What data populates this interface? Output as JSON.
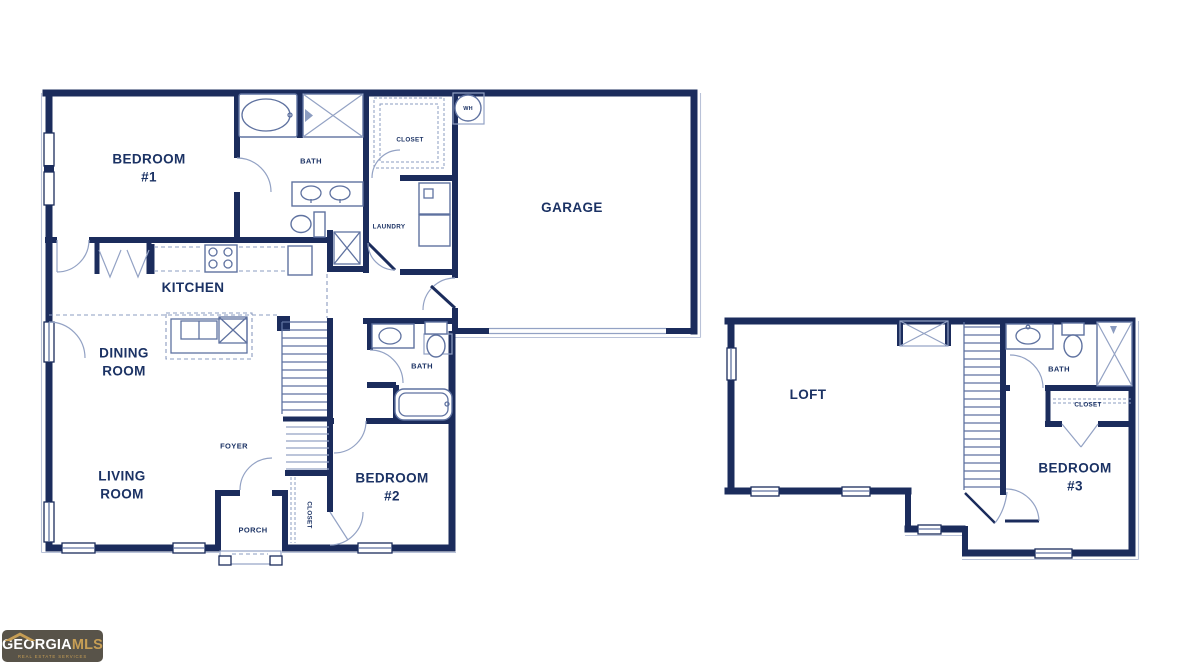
{
  "colors": {
    "wall_navy": "#1b2c5c",
    "fixture_line": "#5f72a0",
    "arc_line": "#93a2c4",
    "label_text": "#1b3264",
    "logo_background": "#585349",
    "logo_gold": "#c79e55",
    "logo_white": "#ffffff"
  },
  "floor1": {
    "labels": {
      "bedroom1": "BEDROOM\n#1",
      "bath1": "BATH",
      "closet1": "CLOSET",
      "laundry": "LAUNDRY",
      "wh": "WH",
      "garage": "GARAGE",
      "kitchen": "KITCHEN",
      "dining": "DINING\nROOM",
      "foyer": "FOYER",
      "bath2": "BATH",
      "bedroom2": "BEDROOM\n#2",
      "closet2": "CLOSET",
      "living": "LIVING\nROOM",
      "porch": "PORCH"
    }
  },
  "floor2": {
    "labels": {
      "loft": "LOFT",
      "bath3": "BATH",
      "closet3": "CLOSET",
      "bedroom3": "BEDROOM\n#3"
    }
  },
  "logo": {
    "brand_primary": "GEORGIA",
    "brand_secondary": "MLS",
    "tagline": "REAL ESTATE SERVICES"
  }
}
